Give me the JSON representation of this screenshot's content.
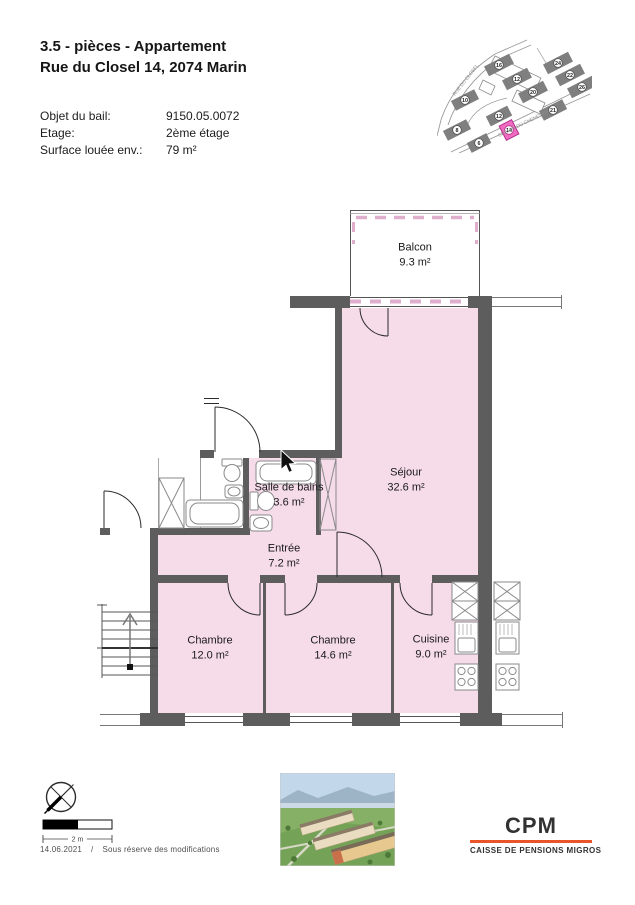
{
  "header": {
    "title_line1": "3.5 - pièces - Appartement",
    "title_line2": "Rue du Closel 14, 2074 Marin",
    "details": [
      {
        "label": "Objet du bail:",
        "value": "9150.05.0072"
      },
      {
        "label": "Etage:",
        "value": "2ème étage"
      },
      {
        "label": "Surface louée env.:",
        "value": "79 m²"
      }
    ]
  },
  "site_map": {
    "streets": [
      {
        "name": "RUE DU CLOSEL"
      },
      {
        "name": "CHEMIN DU CHENEVIER"
      }
    ],
    "highlighted_building": "14",
    "buildings": [
      {
        "num": "16"
      },
      {
        "num": "12"
      },
      {
        "num": "20"
      },
      {
        "num": "24"
      },
      {
        "num": "22"
      },
      {
        "num": "26"
      },
      {
        "num": "10"
      },
      {
        "num": "12"
      },
      {
        "num": "21"
      },
      {
        "num": "8"
      },
      {
        "num": "6"
      },
      {
        "num": "14"
      }
    ]
  },
  "floorplan": {
    "rooms": [
      {
        "name": "Balcon",
        "area": "9.3 m²"
      },
      {
        "name": "Séjour",
        "area": "32.6 m²"
      },
      {
        "name": "Salle de bains",
        "area": "3.6 m²"
      },
      {
        "name": "Entrée",
        "area": "7.2 m²"
      },
      {
        "name": "Chambre",
        "area": "12.0 m²"
      },
      {
        "name": "Chambre",
        "area": "14.6 m²"
      },
      {
        "name": "Cuisine",
        "area": "9.0 m²"
      }
    ],
    "stairs_direction": "up"
  },
  "footer": {
    "scale_label": "2 m",
    "date": "14.06.2021",
    "separator": "/",
    "disclaimer": "Sous réserve des modifications",
    "logo": {
      "name": "CPM",
      "subtitle": "CAISSE DE PENSIONS MIGROS",
      "accent_color": "#e8552a"
    }
  },
  "colors": {
    "room_fill": "#f6dbe9",
    "wall": "#5d5d5d",
    "highlight_pink": "#ef6cc0",
    "logo_accent": "#e8552a"
  }
}
